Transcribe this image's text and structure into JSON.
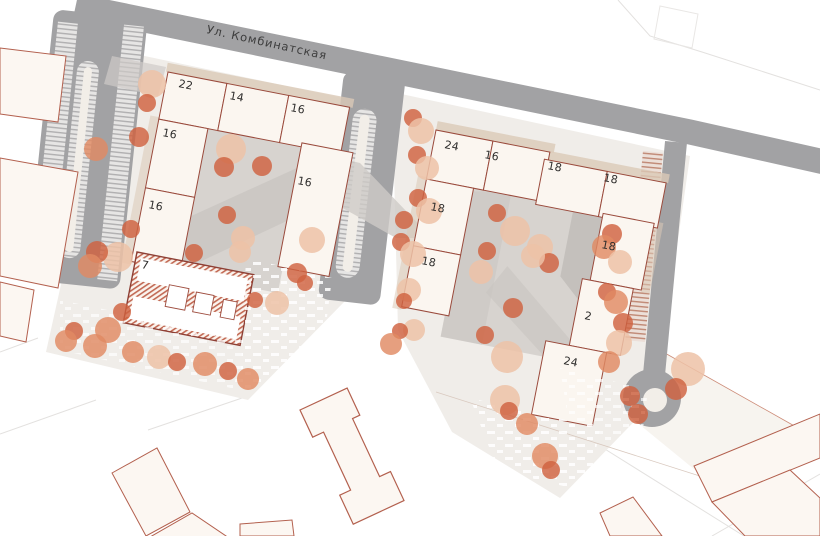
{
  "street": {
    "label": "Ул. Комбинатская"
  },
  "complex_left": {
    "sections": [
      {
        "label": "22"
      },
      {
        "label": "14"
      },
      {
        "label": "16"
      },
      {
        "label": "16"
      },
      {
        "label": "16"
      },
      {
        "label": "16"
      }
    ]
  },
  "kindergarten": {
    "label": "7"
  },
  "complex_right": {
    "sections": [
      {
        "label": "24"
      },
      {
        "label": "16"
      },
      {
        "label": "18"
      },
      {
        "label": "18"
      },
      {
        "label": "18"
      },
      {
        "label": "18"
      },
      {
        "label": "18"
      },
      {
        "label": "2"
      },
      {
        "label": "24"
      }
    ]
  },
  "colors": {
    "road": "#a2a2a4",
    "paving": "#f0ede9",
    "lawn": "#f7f4ef",
    "courtyard": "#d7d3cf",
    "shadow": "#c8c4c0",
    "building_fill": "#fbf6f0",
    "building_stroke": "#9a4a3c",
    "neighbor_fill": "#fcf7f2",
    "neighbor_stroke": "#b3604e",
    "island": "#f2eee8",
    "tan_strip": "#dbc9b6",
    "tree": {
      "dark": "#cf6240",
      "mid": "#e08a63",
      "light": "#edc2a7"
    }
  },
  "trees": [
    {
      "x": 152,
      "y": 84,
      "r": 14,
      "t": "light"
    },
    {
      "x": 147,
      "y": 103,
      "r": 9,
      "t": "dark"
    },
    {
      "x": 139,
      "y": 137,
      "r": 10,
      "t": "dark"
    },
    {
      "x": 96,
      "y": 149,
      "r": 12,
      "t": "mid"
    },
    {
      "x": 131,
      "y": 229,
      "r": 9,
      "t": "dark"
    },
    {
      "x": 118,
      "y": 257,
      "r": 15,
      "t": "light"
    },
    {
      "x": 97,
      "y": 252,
      "r": 11,
      "t": "dark"
    },
    {
      "x": 90,
      "y": 266,
      "r": 12,
      "t": "mid"
    },
    {
      "x": 122,
      "y": 312,
      "r": 9,
      "t": "dark"
    },
    {
      "x": 108,
      "y": 330,
      "r": 13,
      "t": "mid"
    },
    {
      "x": 74,
      "y": 331,
      "r": 9,
      "t": "dark"
    },
    {
      "x": 66,
      "y": 341,
      "r": 11,
      "t": "mid"
    },
    {
      "x": 95,
      "y": 346,
      "r": 12,
      "t": "mid"
    },
    {
      "x": 133,
      "y": 352,
      "r": 11,
      "t": "mid"
    },
    {
      "x": 159,
      "y": 357,
      "r": 12,
      "t": "light"
    },
    {
      "x": 177,
      "y": 362,
      "r": 9,
      "t": "dark"
    },
    {
      "x": 205,
      "y": 364,
      "r": 12,
      "t": "mid"
    },
    {
      "x": 228,
      "y": 371,
      "r": 9,
      "t": "dark"
    },
    {
      "x": 248,
      "y": 379,
      "r": 11,
      "t": "mid"
    },
    {
      "x": 231,
      "y": 149,
      "r": 15,
      "t": "light"
    },
    {
      "x": 224,
      "y": 167,
      "r": 10,
      "t": "dark"
    },
    {
      "x": 262,
      "y": 166,
      "r": 10,
      "t": "dark"
    },
    {
      "x": 227,
      "y": 215,
      "r": 9,
      "t": "dark"
    },
    {
      "x": 243,
      "y": 238,
      "r": 12,
      "t": "light"
    },
    {
      "x": 240,
      "y": 252,
      "r": 11,
      "t": "light"
    },
    {
      "x": 194,
      "y": 253,
      "r": 9,
      "t": "dark"
    },
    {
      "x": 297,
      "y": 273,
      "r": 10,
      "t": "dark"
    },
    {
      "x": 312,
      "y": 240,
      "r": 13,
      "t": "light"
    },
    {
      "x": 277,
      "y": 303,
      "r": 12,
      "t": "light"
    },
    {
      "x": 255,
      "y": 300,
      "r": 8,
      "t": "dark"
    },
    {
      "x": 305,
      "y": 283,
      "r": 8,
      "t": "dark"
    },
    {
      "x": 413,
      "y": 118,
      "r": 9,
      "t": "dark"
    },
    {
      "x": 421,
      "y": 131,
      "r": 13,
      "t": "light"
    },
    {
      "x": 417,
      "y": 155,
      "r": 9,
      "t": "dark"
    },
    {
      "x": 427,
      "y": 168,
      "r": 12,
      "t": "light"
    },
    {
      "x": 418,
      "y": 198,
      "r": 9,
      "t": "dark"
    },
    {
      "x": 429,
      "y": 211,
      "r": 13,
      "t": "light"
    },
    {
      "x": 404,
      "y": 220,
      "r": 9,
      "t": "dark"
    },
    {
      "x": 401,
      "y": 242,
      "r": 9,
      "t": "dark"
    },
    {
      "x": 413,
      "y": 254,
      "r": 13,
      "t": "light"
    },
    {
      "x": 409,
      "y": 290,
      "r": 12,
      "t": "light"
    },
    {
      "x": 404,
      "y": 301,
      "r": 8,
      "t": "dark"
    },
    {
      "x": 414,
      "y": 330,
      "r": 11,
      "t": "light"
    },
    {
      "x": 400,
      "y": 331,
      "r": 8,
      "t": "dark"
    },
    {
      "x": 391,
      "y": 344,
      "r": 11,
      "t": "mid"
    },
    {
      "x": 497,
      "y": 213,
      "r": 9,
      "t": "dark"
    },
    {
      "x": 515,
      "y": 231,
      "r": 15,
      "t": "light"
    },
    {
      "x": 540,
      "y": 247,
      "r": 13,
      "t": "light"
    },
    {
      "x": 487,
      "y": 251,
      "r": 9,
      "t": "dark"
    },
    {
      "x": 549,
      "y": 263,
      "r": 10,
      "t": "dark"
    },
    {
      "x": 481,
      "y": 272,
      "r": 12,
      "t": "light"
    },
    {
      "x": 533,
      "y": 256,
      "r": 12,
      "t": "light"
    },
    {
      "x": 513,
      "y": 308,
      "r": 10,
      "t": "dark"
    },
    {
      "x": 485,
      "y": 335,
      "r": 9,
      "t": "dark"
    },
    {
      "x": 507,
      "y": 357,
      "r": 16,
      "t": "light"
    },
    {
      "x": 505,
      "y": 400,
      "r": 15,
      "t": "light"
    },
    {
      "x": 509,
      "y": 411,
      "r": 9,
      "t": "dark"
    },
    {
      "x": 527,
      "y": 424,
      "r": 11,
      "t": "mid"
    },
    {
      "x": 545,
      "y": 456,
      "r": 13,
      "t": "mid"
    },
    {
      "x": 551,
      "y": 470,
      "r": 9,
      "t": "dark"
    },
    {
      "x": 612,
      "y": 234,
      "r": 10,
      "t": "dark"
    },
    {
      "x": 604,
      "y": 247,
      "r": 12,
      "t": "mid"
    },
    {
      "x": 620,
      "y": 262,
      "r": 12,
      "t": "light"
    },
    {
      "x": 607,
      "y": 292,
      "r": 9,
      "t": "dark"
    },
    {
      "x": 616,
      "y": 302,
      "r": 12,
      "t": "mid"
    },
    {
      "x": 623,
      "y": 323,
      "r": 10,
      "t": "dark"
    },
    {
      "x": 619,
      "y": 343,
      "r": 13,
      "t": "light"
    },
    {
      "x": 609,
      "y": 362,
      "r": 11,
      "t": "mid"
    },
    {
      "x": 630,
      "y": 396,
      "r": 10,
      "t": "dark"
    },
    {
      "x": 638,
      "y": 414,
      "r": 10,
      "t": "dark"
    },
    {
      "x": 688,
      "y": 369,
      "r": 17,
      "t": "light"
    },
    {
      "x": 676,
      "y": 389,
      "r": 11,
      "t": "dark"
    }
  ]
}
